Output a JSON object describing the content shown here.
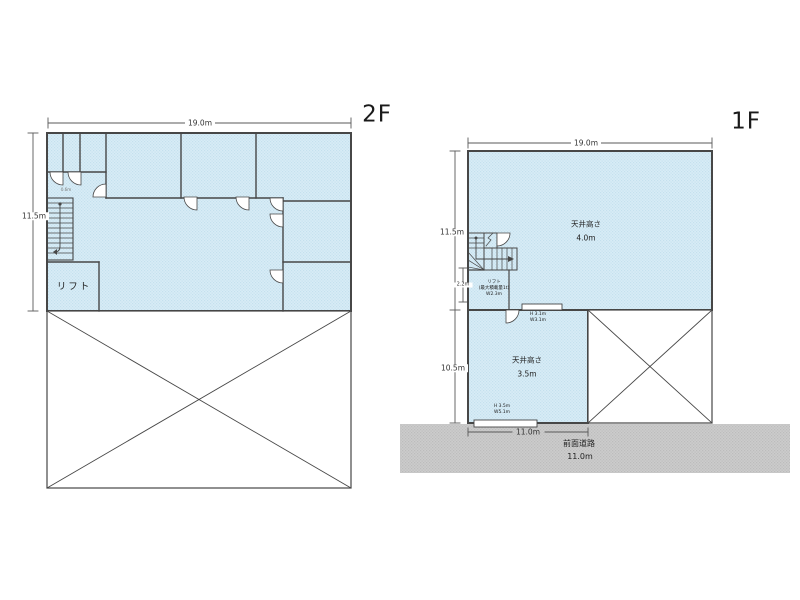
{
  "colors": {
    "room_fill_base": "#d2e8f3",
    "wall": "#474747",
    "dim_line": "#5a5a5a",
    "road_fill_base": "#c7c7c7",
    "text": "#333333"
  },
  "floor2": {
    "label": "2F",
    "dim_width": "19.0m",
    "dim_height": "11.5m",
    "lift_room": "リフト",
    "stair_note": "0.6m"
  },
  "floor1": {
    "label": "1F",
    "dim_width": "19.0m",
    "dim_height_upper": "11.5m",
    "dim_stair": "2.2m",
    "dim_height_lower": "10.5m",
    "dim_room_width": "11.0m",
    "ceiling_upper_1": "天井高さ",
    "ceiling_upper_2": "4.0m",
    "ceiling_lower_1": "天井高さ",
    "ceiling_lower_2": "3.5m",
    "lift_note_1": "リフト",
    "lift_note_2": "(最大積載量1t)",
    "lift_note_3": "W2.3m",
    "opening_mid_1": "H 3.1m",
    "opening_mid_2": "W3.1m",
    "opening_bottom_1": "H 3.5m",
    "opening_bottom_2": "W5.1m",
    "road_1": "前面道路",
    "road_2": "11.0m"
  }
}
